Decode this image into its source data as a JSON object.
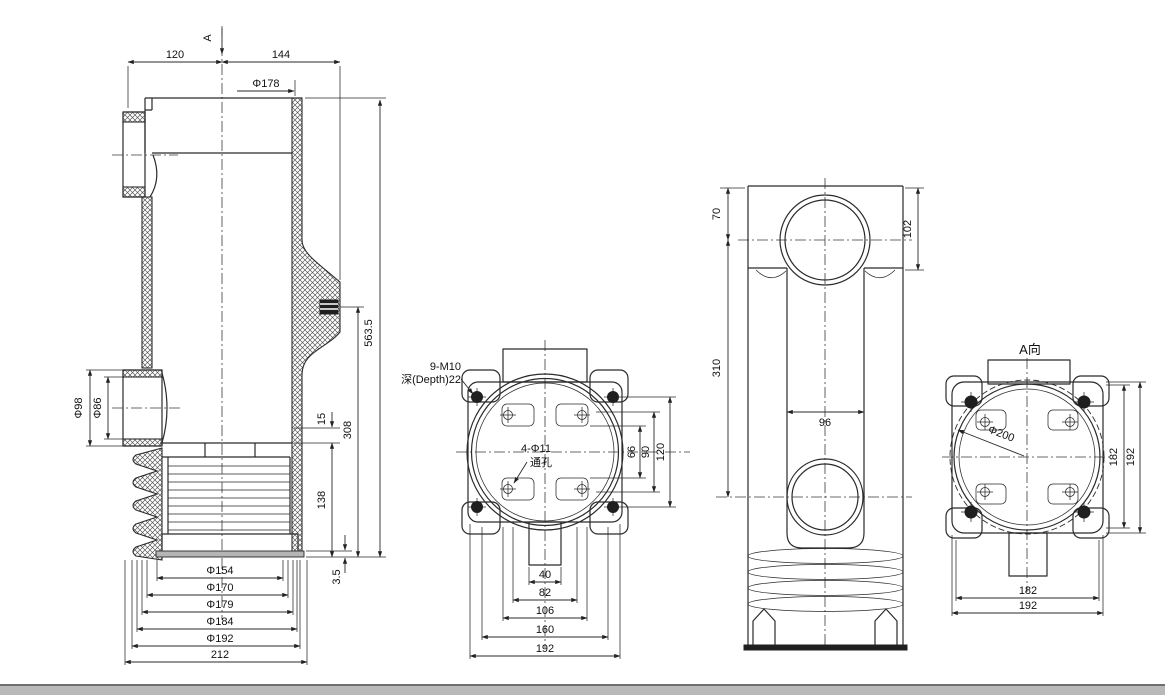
{
  "drawing": {
    "section_view": {
      "cut_label": "A",
      "dims": {
        "left_width": "120",
        "right_width": "144",
        "top_diameter": "Φ178",
        "total_height": "563.5",
        "mid_height": "308",
        "step_height": "15",
        "shed_height": "138",
        "base_thickness": "3.5",
        "boss_outer": "Φ98",
        "boss_inner": "Φ86",
        "dia_154": "Φ154",
        "dia_170": "Φ170",
        "dia_179": "Φ179",
        "dia_184": "Φ184",
        "dia_192": "Φ192",
        "base_width": "212"
      }
    },
    "flange_view": {
      "tapped_note_1": "9-M10",
      "tapped_note_2": "深(Depth)22",
      "through_note_1": "4-Φ11",
      "through_note_2": "通孔",
      "dims": {
        "v_66": "66",
        "v_90": "90",
        "v_120": "120",
        "w_40": "40",
        "w_82": "82",
        "w_106": "106",
        "w_160": "160",
        "w_192": "192"
      }
    },
    "side_view": {
      "dims": {
        "top_to_center": "70",
        "head_height": "102",
        "center_to_center": "310",
        "slot_width": "96"
      }
    },
    "a_view": {
      "title": "A向",
      "dims": {
        "bolt_circle": "Φ200",
        "v_182": "182",
        "v_192": "192",
        "h_182": "182",
        "h_192": "192"
      }
    }
  }
}
